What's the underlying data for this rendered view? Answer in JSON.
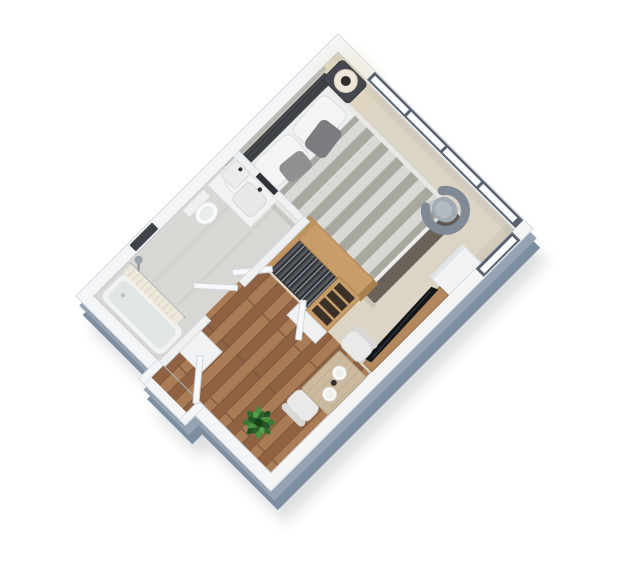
{
  "scene": {
    "description": "3D isometric top-down render of a studio apartment floor plan on a white background",
    "background": "#ffffff",
    "rooms": [
      "bedroom-living-area",
      "bathroom",
      "entry-hall",
      "dining-nook"
    ],
    "inventory": [
      "panorama-windows",
      "side-window",
      "double-bed",
      "headboard",
      "pillows",
      "accent-pillows",
      "striped-duvet",
      "foot-bench",
      "nightstand",
      "table-lamp",
      "armchair",
      "storage-cabinet",
      "tv-console",
      "tv",
      "wardrobe-bridge",
      "open-closet-with-clothes",
      "closet-doors",
      "wood-shelf-column",
      "low-cabinet",
      "dining-table",
      "dining-chairs",
      "plates",
      "potted-plant",
      "vanity-counter",
      "basin",
      "wall-niche",
      "toilet",
      "bathtub",
      "shower-curtain",
      "shower-head",
      "radiator-niche",
      "bathroom-door",
      "entrance-door",
      "hall-cabinet",
      "wood-plank-floor",
      "beige-carpet",
      "tile-floor"
    ]
  },
  "palette": {
    "wall_top": "#f4f5f7",
    "wall_side": "#7e8ea1",
    "wall_side_light": "#95a3b3",
    "shadow": "#2f3a46",
    "window_frame": "#59626e",
    "glass": "#fcfdfe",
    "carpet": "#dcd5c5",
    "tile": "#d8d7d3",
    "wood_floor": "#9c6f4c",
    "wood_furniture": "#c89d6a",
    "tv_console": "#b2885c",
    "duvet_light": "#d9d9d6",
    "duvet_dark": "#a8a8a1",
    "headboard": "#43464b",
    "pillow": "#f4f4f2",
    "armchair": "#a2aab4",
    "tv": "#141519",
    "dining_table": "#cbbaa0",
    "chair": "#e9eae8",
    "plant": "#2f6b31",
    "door": "#f7f8fa",
    "fixture_white": "#f1f2f2"
  }
}
